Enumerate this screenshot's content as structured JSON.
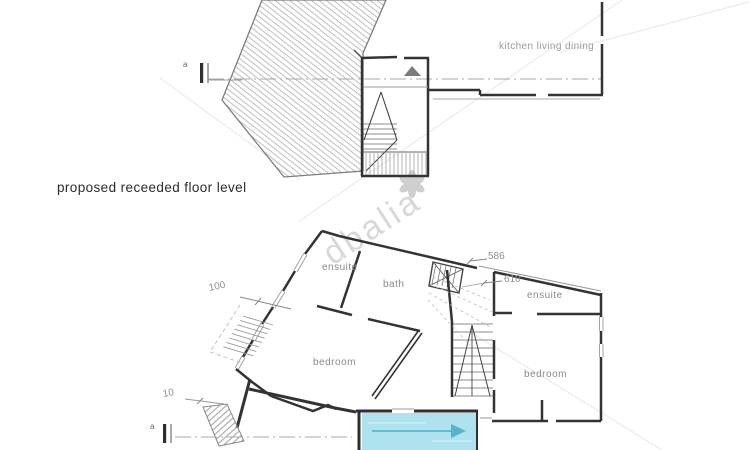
{
  "page": {
    "background": "#ffffff"
  },
  "upper_plan": {
    "room_label": "kitchen living dining",
    "section_marker_label": "a"
  },
  "caption": {
    "text": "proposed receeded floor level"
  },
  "lower_plan": {
    "rooms": {
      "ensuite_left": "ensuite",
      "bath": "bath",
      "ensuite_right": "ensuite",
      "bedroom_left": "bedroom",
      "bedroom_right": "bedroom"
    },
    "dimensions": {
      "stair_width": "586",
      "stair_depth": "610",
      "window_dim": "100",
      "lower_dim": "10"
    },
    "section_marker_label": "a",
    "pool": {
      "fill": "#ade2ee",
      "arrow": "#55b4ca"
    }
  },
  "watermark": {
    "text": "dbalia"
  },
  "colors": {
    "wall": "#333333",
    "thin_line": "#999999",
    "hatch": "#b8b8b8",
    "label_text": "#8a8a8a",
    "dimension_text": "#8f8f8f",
    "caption_text": "#2b2b2b",
    "watermark_text": "#d8d8d8"
  }
}
